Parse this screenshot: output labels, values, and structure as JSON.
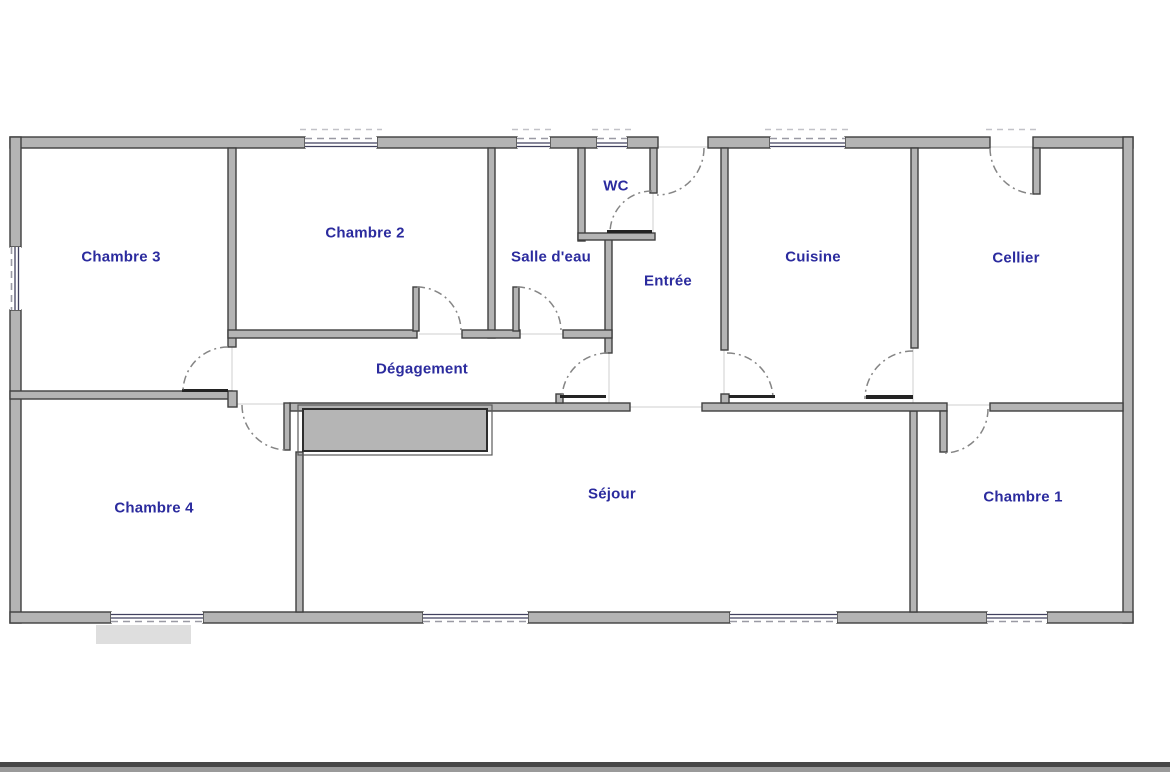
{
  "floorplan": {
    "title": "Plan d'appartement",
    "label_color": "#2b2b9e",
    "wall_fill": "#b4b4b4",
    "wall_stroke": "#3f3f3f",
    "rooms": [
      {
        "id": "chambre-3",
        "label": "Chambre 3"
      },
      {
        "id": "chambre-2",
        "label": "Chambre 2"
      },
      {
        "id": "salle-deau",
        "label": "Salle d'eau"
      },
      {
        "id": "wc",
        "label": "WC"
      },
      {
        "id": "entree",
        "label": "Entrée"
      },
      {
        "id": "cuisine",
        "label": "Cuisine"
      },
      {
        "id": "cellier",
        "label": "Cellier"
      },
      {
        "id": "degagement",
        "label": "Dégagement"
      },
      {
        "id": "chambre-4",
        "label": "Chambre 4"
      },
      {
        "id": "sejour",
        "label": "Séjour"
      },
      {
        "id": "chambre-1",
        "label": "Chambre 1"
      }
    ]
  }
}
